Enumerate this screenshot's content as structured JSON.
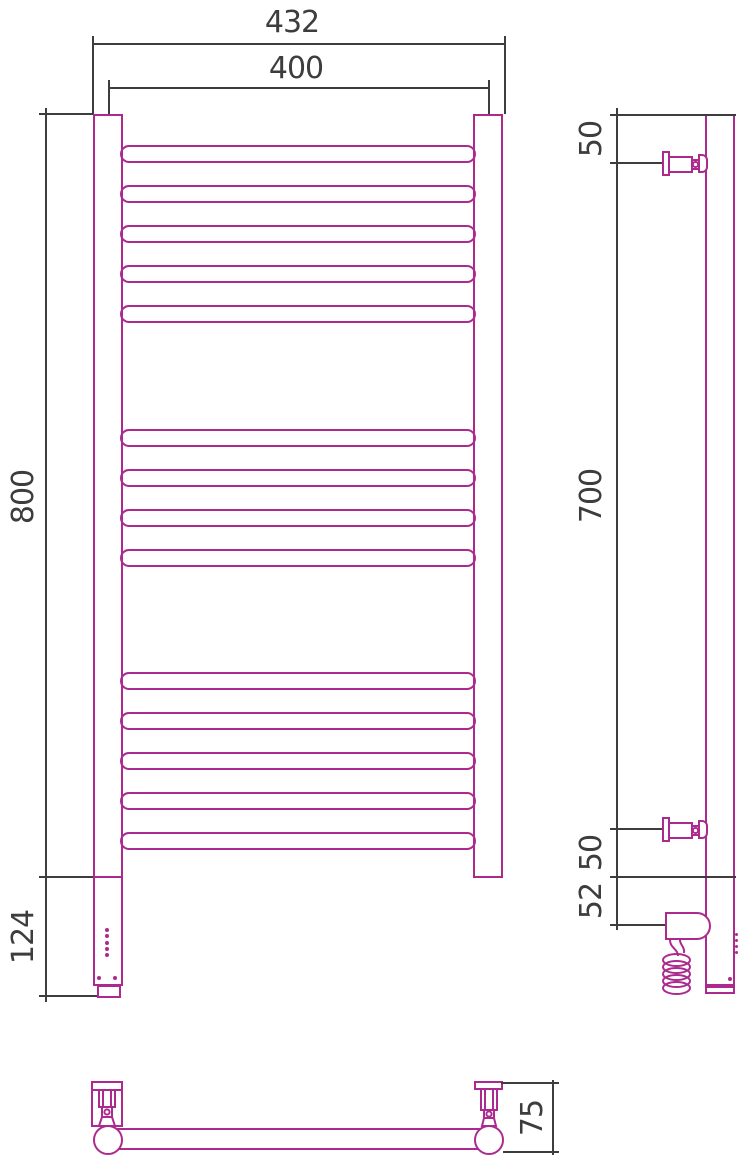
{
  "drawing": {
    "type": "technical-dimension-drawing",
    "subject": "ladder-style heated towel rail, front / side / bottom views",
    "colors": {
      "product_outline": "#ac2a8e",
      "dimension_lines": "#3d3d3d",
      "background": "#ffffff"
    },
    "structure": {
      "rung_groups": [
        5,
        4,
        5
      ],
      "rung_total": 14
    },
    "dims": {
      "overall_width": "432",
      "pipe_center_distance": "400",
      "rail_height": "800",
      "housing_height": "124",
      "top_bracket_offset": "50",
      "bracket_span": "700",
      "bottom_bracket_offset": "50",
      "heater_axis_offset": "52",
      "wall_depth": "75"
    }
  }
}
